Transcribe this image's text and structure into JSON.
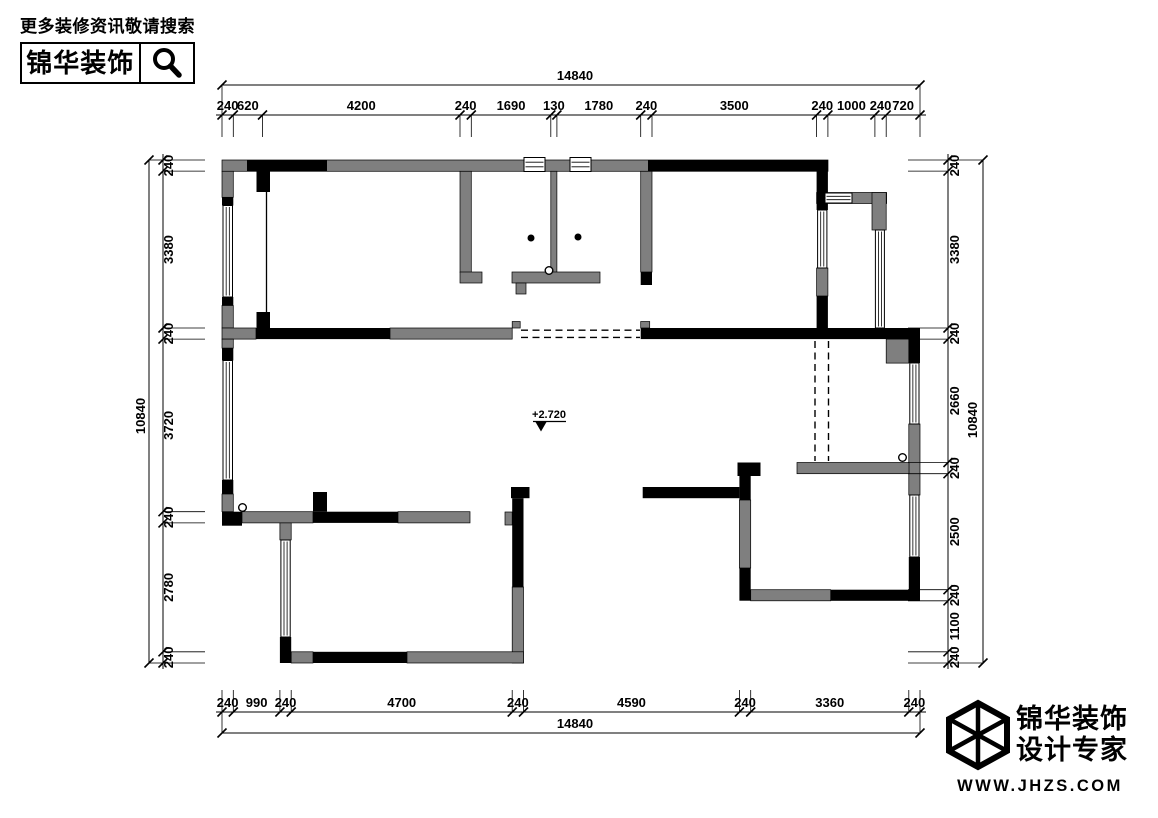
{
  "header": {
    "search_hint": "更多装修资讯敬请搜索",
    "brand": "锦华装饰"
  },
  "footer": {
    "brand_line1": "锦华装饰",
    "brand_line2": "设计专家",
    "website": "WWW.JHZS.COM"
  },
  "plan": {
    "level_marker": "+2.720",
    "colors": {
      "wall_primary": "#000000",
      "wall_secondary": "#7f7f7f"
    },
    "dimensions": {
      "top": {
        "overall": "14840",
        "segments": [
          "240",
          "620",
          "4200",
          "240",
          "1690",
          "130",
          "1780",
          "240",
          "3500",
          "240",
          "1000",
          "240",
          "720"
        ]
      },
      "bottom": {
        "overall": "14840",
        "segments": [
          "240",
          "990",
          "240",
          "4700",
          "240",
          "4590",
          "240",
          "3360",
          "240"
        ]
      },
      "left": {
        "overall": "10840",
        "segments": [
          "240",
          "3380",
          "240",
          "3720",
          "240",
          "2780",
          "240"
        ]
      },
      "right": {
        "overall": "10840",
        "segments": [
          "240",
          "3380",
          "240",
          "2660",
          "240",
          "2500",
          "240",
          "1100",
          "240"
        ]
      }
    }
  }
}
